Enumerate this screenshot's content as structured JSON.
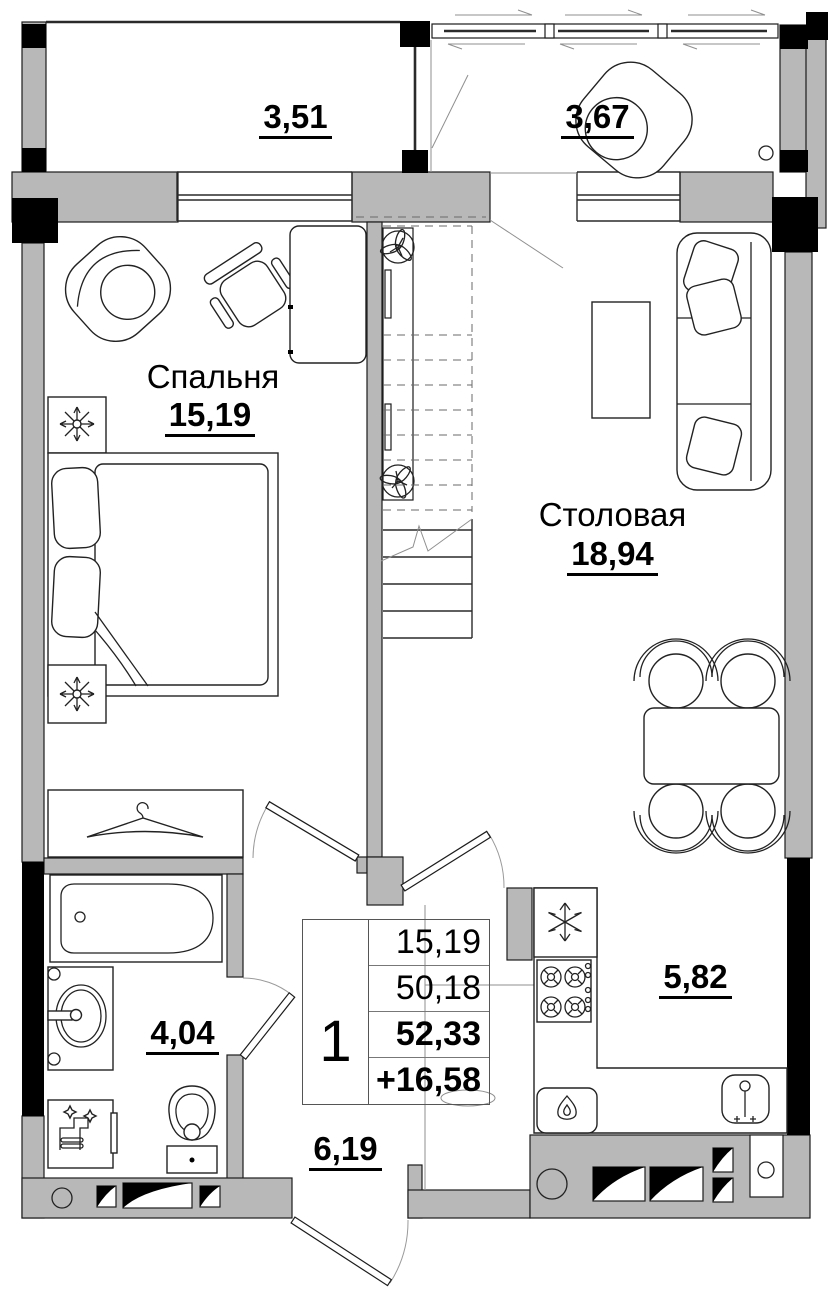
{
  "plan": {
    "rooms": {
      "bedroom": {
        "name": "Спальня",
        "area": "15,19"
      },
      "dining": {
        "name": "Столовая",
        "area": "18,94"
      },
      "balcony_left": {
        "area": "3,51"
      },
      "balcony_right": {
        "area": "3,67"
      },
      "bathroom": {
        "area": "4,04"
      },
      "hallway": {
        "area": "6,19"
      },
      "kitchen": {
        "area": "5,82"
      }
    },
    "info_table": {
      "rooms_count": "1",
      "living_area": "15,19",
      "area_without_summer": "50,18",
      "total_area": "52,33",
      "summer_area": "+16,58"
    },
    "colors": {
      "wall_fill": "#b8b8b8",
      "column_fill": "#000000",
      "outline": "#1c1c1c"
    }
  }
}
